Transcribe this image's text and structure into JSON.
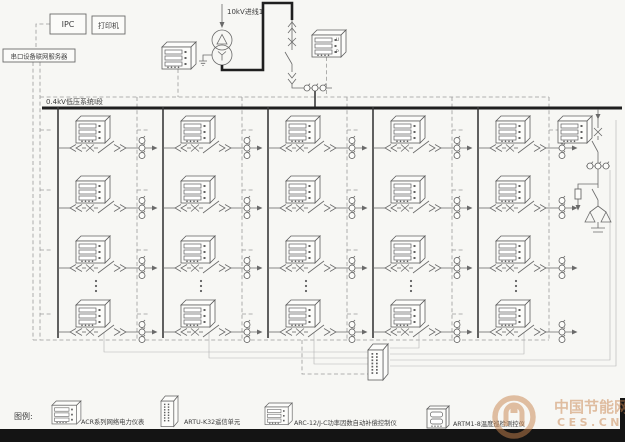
{
  "header": {
    "ipc": "IPC",
    "printer": "打印机",
    "server": "串口设备联网服务器",
    "incoming_line": "10kV进线1",
    "bus": "0.4kV低压系统Ⅰ段"
  },
  "meter_display": {
    "top": "U",
    "bottom": "P"
  },
  "legend": {
    "title": "图例:",
    "items": [
      {
        "icon": "acr-meter-icon",
        "label": "ACR系列网络电力仪表"
      },
      {
        "icon": "artu-unit-icon",
        "label": "ARTU-K32遥信单元"
      },
      {
        "icon": "arc-controller-icon",
        "label": "ARC-12/J-C功率因数自动补偿控制仪"
      },
      {
        "icon": "artm-instrument-icon",
        "label": "ARTM1-8温度巡检测控仪"
      }
    ]
  },
  "watermark": {
    "title": "中国节能网",
    "domain": "CES.CN"
  },
  "colors": {
    "line": "#6a6a6a",
    "bus": "#1f1f1f",
    "dashed": "#9b9b9b",
    "watermark": "#c9854f"
  }
}
